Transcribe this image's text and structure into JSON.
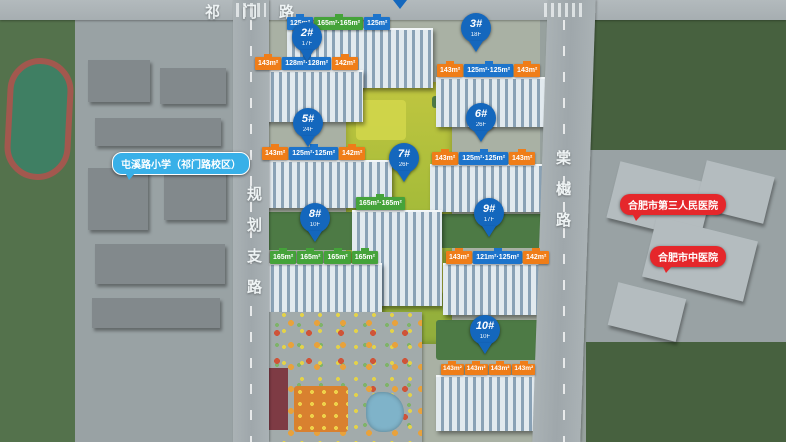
{
  "roads": {
    "top": "祁门路",
    "left": "规划支路",
    "right": "棠樾路"
  },
  "pois": {
    "school": "屯溪路小学（祁门路校区）",
    "hospital_1": "合肥市第三人民医院",
    "hospital_2": "合肥市中医院"
  },
  "buildings": [
    {
      "key": "top-center",
      "label": "",
      "floors": "",
      "chips": [
        {
          "text": "125m²",
          "color": "blue"
        },
        {
          "text": "165m²·165m²",
          "color": "green"
        },
        {
          "text": "125m²",
          "color": "blue"
        }
      ]
    },
    {
      "key": "2",
      "label": "2#",
      "floors": "17F",
      "chips": [
        {
          "text": "143m²",
          "color": "orange"
        },
        {
          "text": "128m²·128m²",
          "color": "blue"
        },
        {
          "text": "142m²",
          "color": "orange"
        }
      ]
    },
    {
      "key": "3",
      "label": "3#",
      "floors": "18F",
      "chips": [
        {
          "text": "143m²",
          "color": "orange"
        },
        {
          "text": "125m²·125m²",
          "color": "blue"
        },
        {
          "text": "143m²",
          "color": "orange"
        }
      ]
    },
    {
      "key": "5",
      "label": "5#",
      "floors": "24F",
      "chips": [
        {
          "text": "143m²",
          "color": "orange"
        },
        {
          "text": "125m²·125m²",
          "color": "blue"
        },
        {
          "text": "142m²",
          "color": "orange"
        }
      ]
    },
    {
      "key": "6",
      "label": "6#",
      "floors": "26F",
      "chips": [
        {
          "text": "143m²",
          "color": "orange"
        },
        {
          "text": "125m²·125m²",
          "color": "blue"
        },
        {
          "text": "143m²",
          "color": "orange"
        }
      ]
    },
    {
      "key": "7",
      "label": "7#",
      "floors": "26F",
      "chips": [
        {
          "text": "165m²·165m²",
          "color": "green"
        }
      ]
    },
    {
      "key": "8",
      "label": "8#",
      "floors": "10F",
      "chips": [
        {
          "text": "165m²",
          "color": "green"
        },
        {
          "text": "165m²",
          "color": "green"
        },
        {
          "text": "165m²",
          "color": "green"
        },
        {
          "text": "165m²",
          "color": "green"
        }
      ]
    },
    {
      "key": "9",
      "label": "9#",
      "floors": "17F",
      "chips": [
        {
          "text": "143m²",
          "color": "orange"
        },
        {
          "text": "121m²·125m²",
          "color": "blue"
        },
        {
          "text": "142m²",
          "color": "orange"
        }
      ]
    },
    {
      "key": "10",
      "label": "10#",
      "floors": "10F",
      "chips": [
        {
          "text": "143m²",
          "color": "orange"
        },
        {
          "text": "143m²",
          "color": "orange"
        },
        {
          "text": "143m²",
          "color": "orange"
        },
        {
          "text": "143m²",
          "color": "orange"
        }
      ]
    }
  ],
  "colors": {
    "pin_blue": "#1467bd",
    "chip_blue": "#1d74cb",
    "chip_green": "#45a33a",
    "chip_orange": "#ef7d18",
    "poi_red": "#e5272b",
    "poi_blue": "#38b0e8",
    "park_green": "#a7bc3a"
  }
}
